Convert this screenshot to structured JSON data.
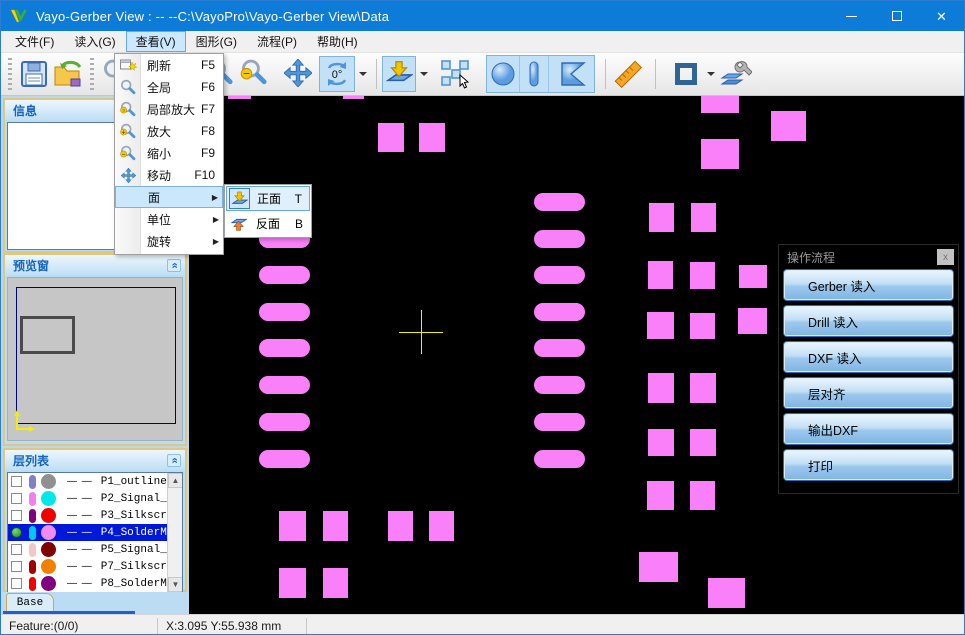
{
  "window": {
    "title": "Vayo-Gerber View : --  --C:\\VayoPro\\Vayo-Gerber View\\Data"
  },
  "menubar": {
    "items": [
      {
        "label": "文件(F)",
        "active": false
      },
      {
        "label": "读入(G)",
        "active": false
      },
      {
        "label": "查看(V)",
        "active": true
      },
      {
        "label": "图形(G)",
        "active": false
      },
      {
        "label": "流程(P)",
        "active": false
      },
      {
        "label": "帮助(H)",
        "active": false
      }
    ]
  },
  "toolbar": {
    "rotate_label": "0°"
  },
  "view_menu": {
    "items": [
      {
        "label": "刷新",
        "shortcut": "F5",
        "icon": "refresh"
      },
      {
        "label": "全局",
        "shortcut": "F6",
        "icon": "zoom-fit"
      },
      {
        "label": "局部放大",
        "shortcut": "F7",
        "icon": "zoom-region"
      },
      {
        "label": "放大",
        "shortcut": "F8",
        "icon": "zoom-in"
      },
      {
        "label": "缩小",
        "shortcut": "F9",
        "icon": "zoom-out"
      },
      {
        "label": "移动",
        "shortcut": "F10",
        "icon": "pan"
      },
      {
        "label": "面",
        "submenu": true,
        "highlighted": true
      },
      {
        "label": "单位",
        "submenu": true
      },
      {
        "label": "旋转",
        "submenu": true
      }
    ]
  },
  "face_submenu": {
    "items": [
      {
        "label": "正面",
        "shortcut": "T",
        "icon": "flip-front",
        "selected": true
      },
      {
        "label": "反面",
        "shortcut": "B",
        "icon": "flip-back",
        "selected": false
      }
    ]
  },
  "dock": {
    "info": {
      "title": "信息"
    },
    "preview": {
      "title": "预览窗"
    },
    "layers": {
      "title": "层列表",
      "line_sample": "— —",
      "rows": [
        {
          "name": "P1_outline",
          "pill": "#8080C8",
          "dot": "#909090",
          "visible": false,
          "selected": false
        },
        {
          "name": "P2_Signal_",
          "pill": "#F080F0",
          "dot": "#00E8E8",
          "visible": false,
          "selected": false
        },
        {
          "name": "P3_Silkscr",
          "pill": "#800080",
          "dot": "#F00000",
          "visible": false,
          "selected": false
        },
        {
          "name": "P4_SolderM",
          "pill": "#00C8F0",
          "dot": "#F08CF0",
          "visible": true,
          "selected": true
        },
        {
          "name": "P5_Signal_",
          "pill": "#F0C8C8",
          "dot": "#800000",
          "visible": false,
          "selected": false
        },
        {
          "name": "P7_Silkscr",
          "pill": "#A00000",
          "dot": "#F08000",
          "visible": false,
          "selected": false
        },
        {
          "name": "P8_SolderM",
          "pill": "#F00000",
          "dot": "#800080",
          "visible": false,
          "selected": false
        }
      ]
    },
    "base_tab": {
      "label": "Base"
    }
  },
  "flow_panel": {
    "title": "操作流程",
    "close_label": "x",
    "buttons": [
      {
        "label": "Gerber 读入"
      },
      {
        "label": "Drill 读入"
      },
      {
        "label": "DXF 读入"
      },
      {
        "label": "层对齐"
      },
      {
        "label": "输出DXF"
      },
      {
        "label": "打印"
      }
    ]
  },
  "statusbar": {
    "feature": "Feature:(0/0)",
    "coords": "X:3.095 Y:55.938 mm"
  },
  "canvas": {
    "background": "#000000",
    "pad_color": "#FA80FA",
    "crosshair_color": "#F0F000",
    "crosshair": {
      "cx": 232,
      "cy": 236,
      "arm": 22
    },
    "stadiums": {
      "w": 51,
      "h": 18,
      "col_x": [
        70,
        345
      ],
      "row_tops": [
        97,
        134,
        170,
        207,
        243,
        280,
        317,
        354
      ]
    },
    "squares": [
      [
        189,
        27,
        26,
        29
      ],
      [
        230,
        27,
        26,
        29
      ],
      [
        512,
        0,
        38,
        17
      ],
      [
        582,
        15,
        35,
        30
      ],
      [
        512,
        43,
        38,
        30
      ],
      [
        460,
        107,
        25,
        29
      ],
      [
        502,
        107,
        25,
        29
      ],
      [
        459,
        165,
        25,
        28
      ],
      [
        501,
        166,
        25,
        27
      ],
      [
        550,
        169,
        28,
        23
      ],
      [
        458,
        216,
        27,
        27
      ],
      [
        501,
        217,
        25,
        26
      ],
      [
        549,
        212,
        29,
        26
      ],
      [
        459,
        277,
        26,
        30
      ],
      [
        501,
        277,
        26,
        30
      ],
      [
        459,
        333,
        26,
        27
      ],
      [
        501,
        333,
        26,
        27
      ],
      [
        458,
        385,
        27,
        29
      ],
      [
        501,
        385,
        25,
        29
      ],
      [
        450,
        456,
        39,
        30
      ],
      [
        519,
        482,
        37,
        30
      ],
      [
        90,
        415,
        27,
        30
      ],
      [
        134,
        415,
        25,
        30
      ],
      [
        199,
        415,
        25,
        30
      ],
      [
        240,
        415,
        25,
        30
      ],
      [
        90,
        472,
        27,
        30
      ],
      [
        134,
        472,
        25,
        30
      ],
      [
        39,
        0,
        23,
        3
      ],
      [
        154,
        0,
        21,
        3
      ]
    ]
  }
}
